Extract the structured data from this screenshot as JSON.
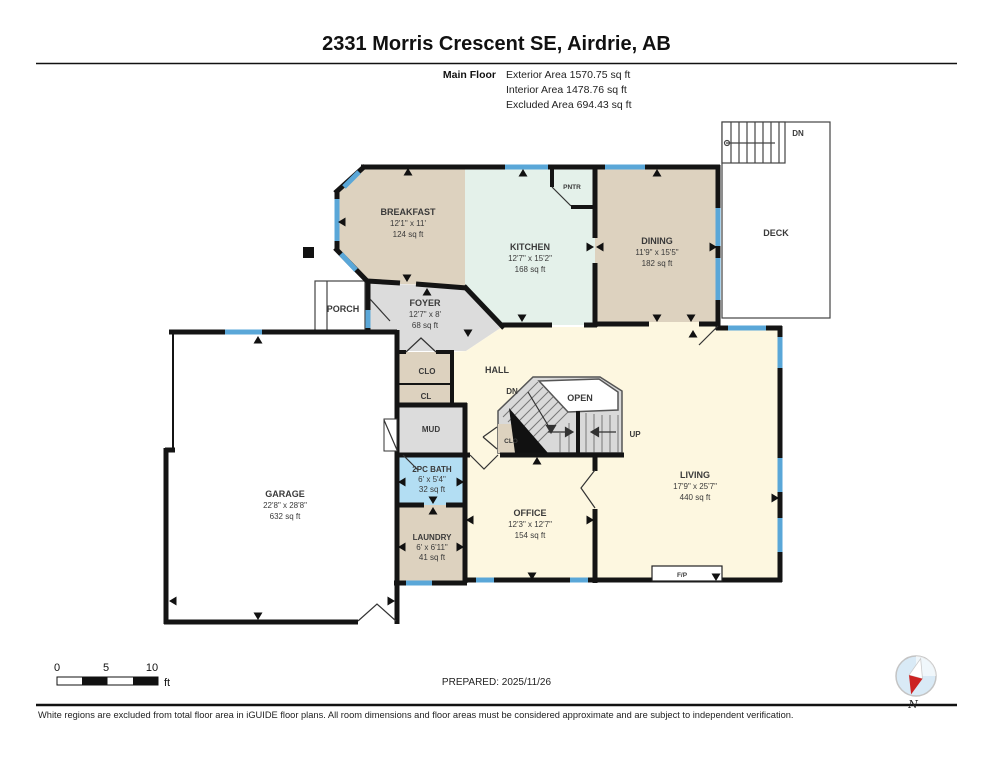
{
  "header": {
    "title": "2331 Morris Crescent SE, Airdrie, AB",
    "floor_label": "Main Floor",
    "areas": [
      {
        "line": "Exterior Area 1570.75 sq ft"
      },
      {
        "line": "Interior Area 1478.76 sq ft"
      },
      {
        "line": "Excluded Area 694.43 sq ft"
      }
    ]
  },
  "rooms": {
    "breakfast": {
      "name": "BREAKFAST",
      "dims": "12'1\" x 11'",
      "area": "124 sq ft"
    },
    "kitchen": {
      "name": "KITCHEN",
      "dims": "12'7\" x 15'2\"",
      "area": "168 sq ft"
    },
    "dining": {
      "name": "DINING",
      "dims": "11'9\" x 15'5\"",
      "area": "182 sq ft"
    },
    "foyer": {
      "name": "FOYER",
      "dims": "12'7\" x 8'",
      "area": "68 sq ft"
    },
    "living": {
      "name": "LIVING",
      "dims": "17'9\" x 25'7\"",
      "area": "440 sq ft"
    },
    "office": {
      "name": "OFFICE",
      "dims": "12'3\" x 12'7\"",
      "area": "154 sq ft"
    },
    "bath": {
      "name": "2PC BATH",
      "dims": "6' x 5'4\"",
      "area": "32 sq ft"
    },
    "laundry": {
      "name": "LAUNDRY",
      "dims": "6' x 6'11\"",
      "area": "41 sq ft"
    },
    "garage": {
      "name": "GARAGE",
      "dims": "22'8\" x 28'8\"",
      "area": "632 sq ft"
    },
    "deck": {
      "name": "DECK"
    },
    "porch": {
      "name": "PORCH"
    },
    "hall": {
      "name": "HALL"
    },
    "pantry": {
      "name": "PNTR"
    },
    "mud": {
      "name": "MUD"
    },
    "closet_foyer": {
      "name": "CLO"
    },
    "closet_cl": {
      "name": "CL"
    },
    "closet_stairs": {
      "name": "CLO"
    },
    "open_below": {
      "name": "OPEN"
    },
    "fireplace": {
      "name": "F/P"
    }
  },
  "stairs": {
    "down_label": "DN",
    "up_label": "UP",
    "deck_down_label": "DN"
  },
  "scale_bar": {
    "tick_0": "0",
    "tick_5": "5",
    "tick_10": "10",
    "unit": "ft"
  },
  "footer": {
    "prepared": "PREPARED: 2025/11/26",
    "disclaimer": "White regions are excluded from total floor area in iGUIDE floor plans. All room dimensions and floor areas must be considered approximate and are subject to independent verification.",
    "compass_north": "N"
  },
  "colors": {
    "wall": "#141414",
    "window": "#5aa7d8",
    "room_tan": "#ddd2bf",
    "room_mint": "#e4f1ea",
    "room_cream": "#fdf7e0",
    "room_gray": "#dcdcdc",
    "room_blue": "#b3def3",
    "excluded_white": "#ffffff",
    "stair_gray": "#d9d9d9"
  }
}
